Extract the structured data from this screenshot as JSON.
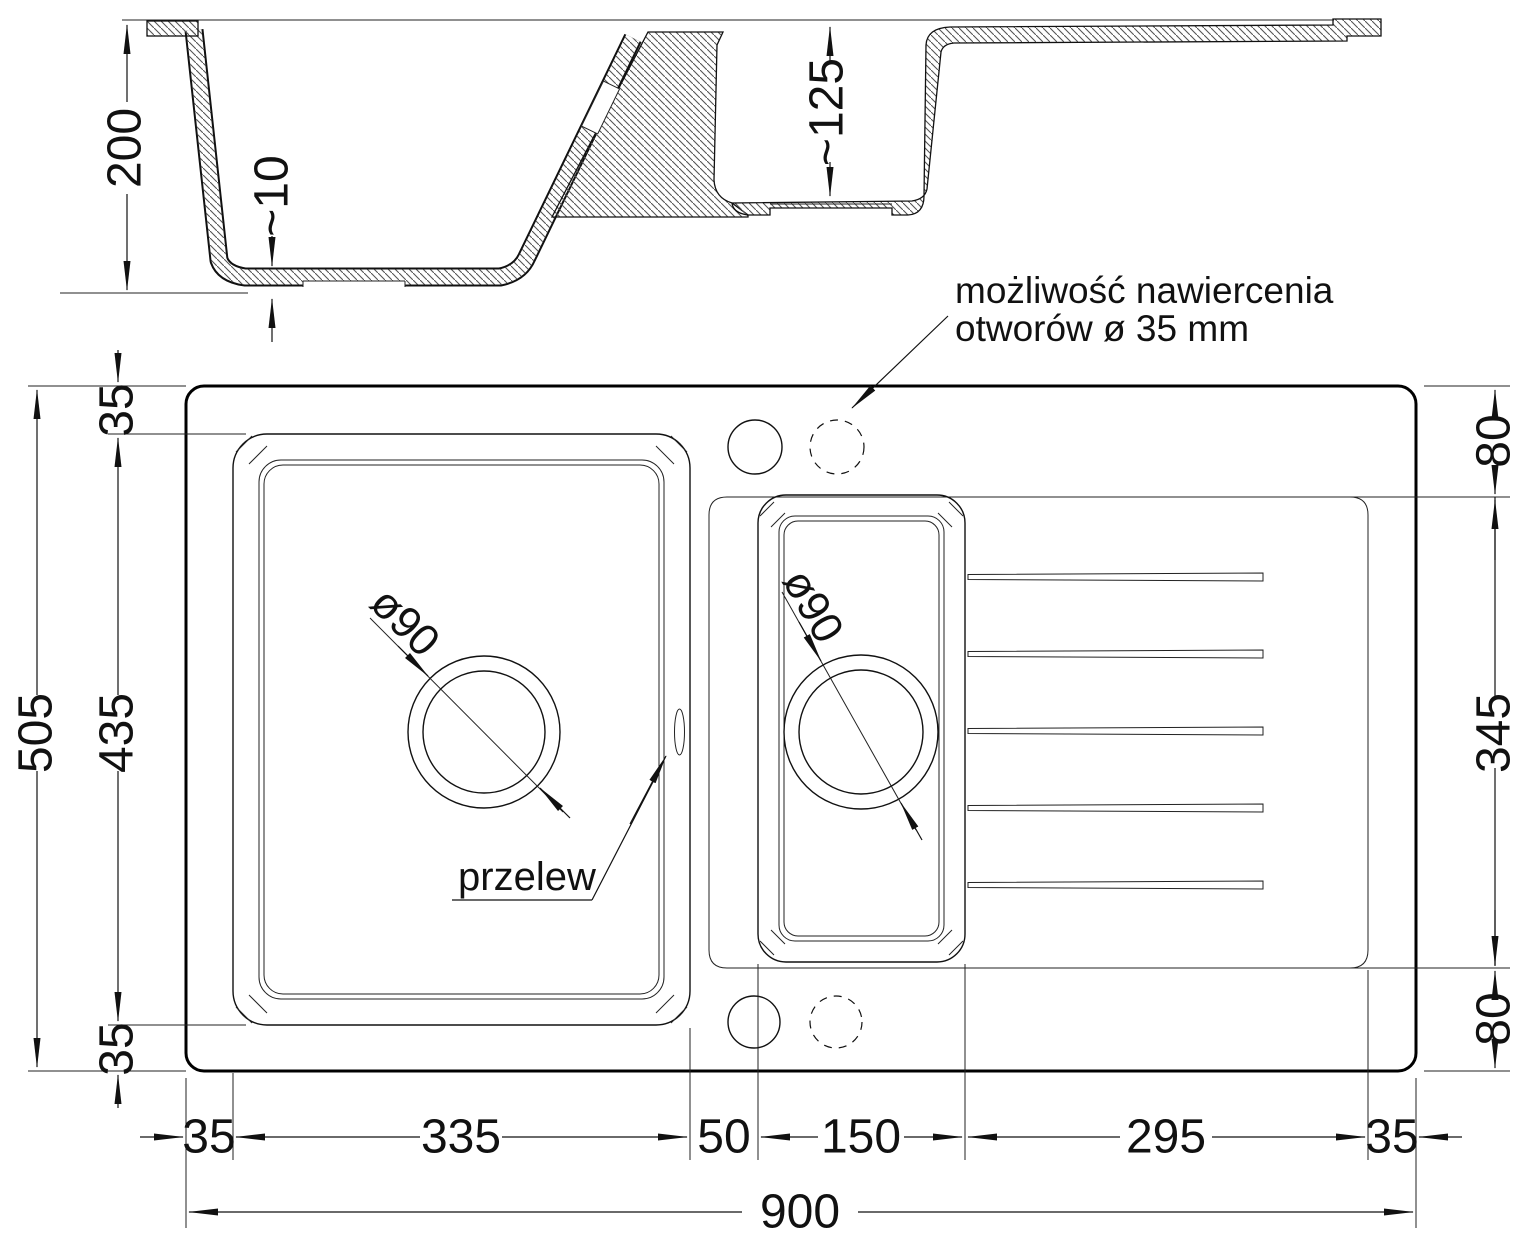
{
  "section_view": {
    "depth_total": "200",
    "bottom_thickness": "~10",
    "small_bowl_depth": "~125"
  },
  "plan_view": {
    "left": {
      "rim_top": "35",
      "bowl_length": "435",
      "overall": "505",
      "rim_bottom": "35"
    },
    "right": {
      "deck_top": "80",
      "drainer_length": "345",
      "deck_bottom": "80"
    },
    "bottom": {
      "rim_left": "35",
      "bowl_width": "335",
      "divider": "50",
      "half_bowl_width": "150",
      "drainer_width": "295",
      "rim_right": "35",
      "overall": "900"
    },
    "drains": {
      "main": "ø90",
      "small": "ø90"
    },
    "overflow_label": "przelew",
    "note_line1": "możliwość nawiercenia",
    "note_line2": "otworów ø 35 mm"
  },
  "style": {
    "line_color": "#111111",
    "background": "#ffffff"
  }
}
